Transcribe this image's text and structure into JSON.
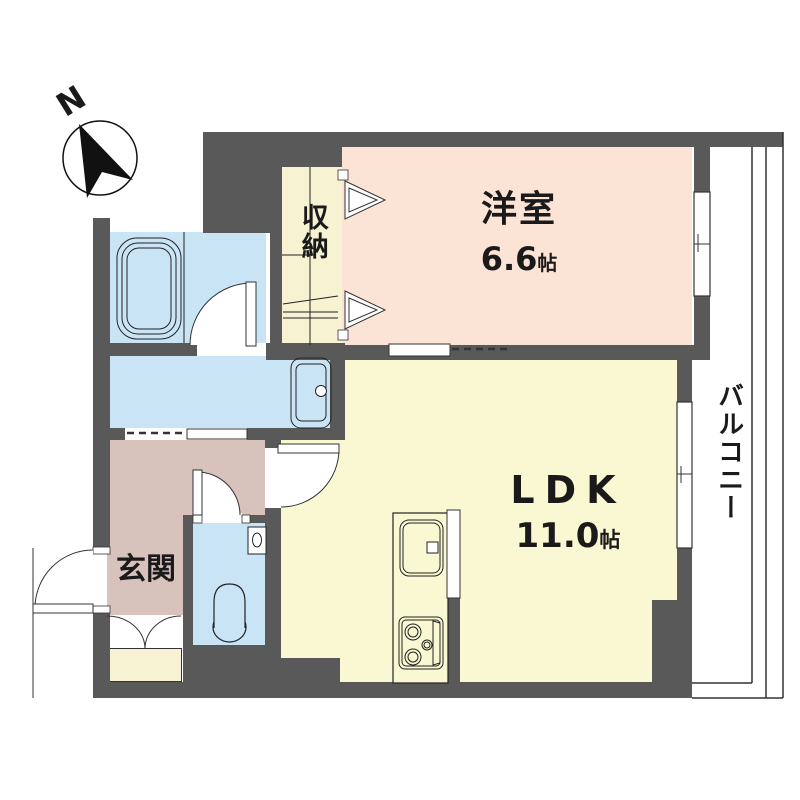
{
  "compass": {
    "label": "N"
  },
  "rooms": {
    "western_room": {
      "name": "洋室",
      "size": "6.6",
      "size_unit": "帖"
    },
    "ldk": {
      "name": "LDK",
      "size": "11.0",
      "size_unit": "帖"
    },
    "closet": {
      "name": "収納"
    },
    "balcony": {
      "name": "バルコニー"
    },
    "entrance": {
      "name": "玄関"
    }
  },
  "palette": {
    "wall": "#595959",
    "western_room": "#fbe3d6",
    "ldk": "#f9f8d2",
    "closet": "#f6f2d2",
    "wet_area": "#c9e4f5",
    "hall": "#d8c2bc",
    "balcony": "#ffffff"
  }
}
